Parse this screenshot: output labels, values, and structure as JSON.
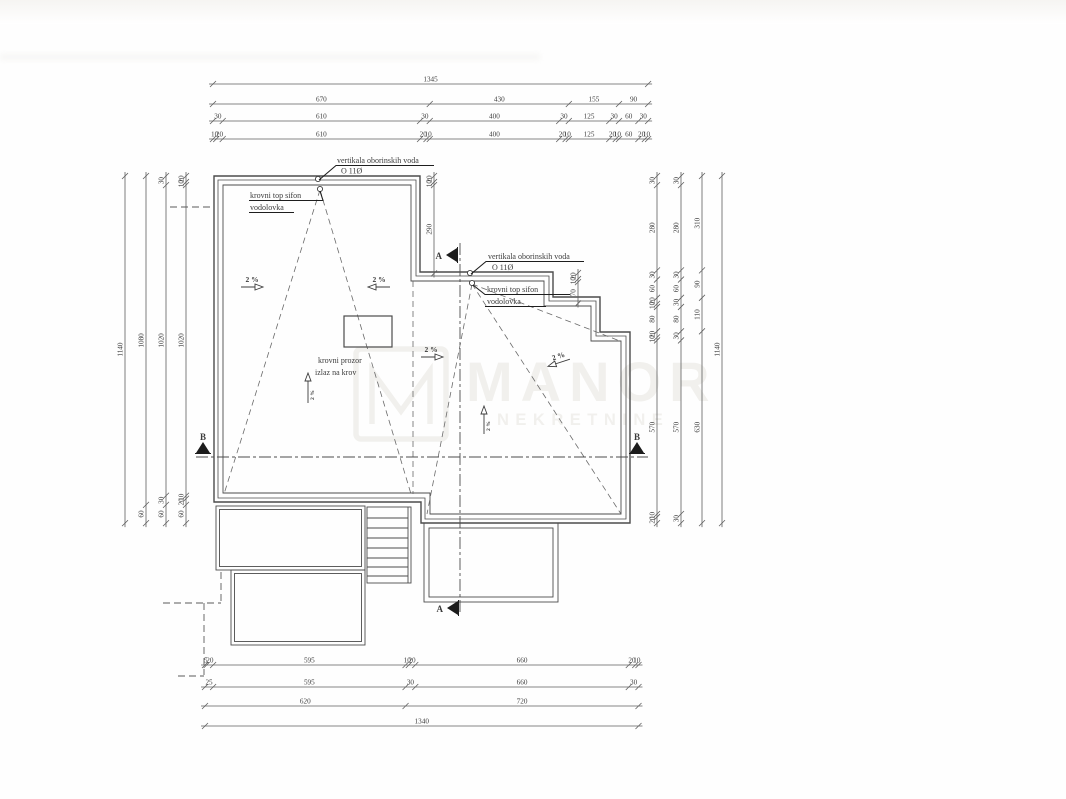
{
  "drawing": {
    "type": "roof plan (architectural drawing)",
    "colors": {
      "line": "#4c4c4c",
      "dim": "#5f5f5f",
      "text": "#3c3c3c",
      "watermark": "#f1f0ed",
      "bg": "#ffffff"
    }
  },
  "watermark": {
    "brand": "MANOR",
    "tagline": "NEKRETNINE"
  },
  "notes": {
    "vertical_drain": "vertikala oborinskih voda",
    "drain_diameter": "O 11Ø",
    "roof_siphon": "krovni top sifon",
    "gutter": "vodolovka",
    "roof_window_line1": "krovni prozor",
    "roof_window_line2": "izlaz na krov",
    "slope": "2 %",
    "section_a": "A",
    "section_b": "B"
  },
  "dim_chains": [
    {
      "name": "top-total",
      "orient": "h",
      "x": 213,
      "y": 84,
      "scale": 0.3235,
      "values": [
        1345
      ]
    },
    {
      "name": "top-groups",
      "orient": "h",
      "x": 213,
      "y": 104,
      "scale": 0.3235,
      "values": [
        670,
        430,
        155,
        90
      ]
    },
    {
      "name": "top-walls",
      "orient": "h",
      "x": 213,
      "y": 121,
      "scale": 0.3235,
      "values": [
        30,
        610,
        30,
        400,
        30,
        125,
        30,
        60,
        30
      ]
    },
    {
      "name": "top-detail",
      "orient": "h",
      "x": 213,
      "y": 139,
      "scale": 0.3235,
      "values": [
        10,
        20,
        610,
        20,
        10,
        400,
        20,
        10,
        125,
        20,
        10,
        60,
        20,
        10
      ]
    },
    {
      "name": "bottom-detail",
      "orient": "h",
      "x": 205,
      "y": 665,
      "scale": 0.3235,
      "values": [
        5,
        20,
        595,
        10,
        20,
        660,
        20,
        10
      ]
    },
    {
      "name": "bottom-walls",
      "orient": "h",
      "x": 205,
      "y": 687,
      "scale": 0.3235,
      "values": [
        25,
        595,
        30,
        660,
        30
      ]
    },
    {
      "name": "bottom-groups",
      "orient": "h",
      "x": 205,
      "y": 706,
      "scale": 0.3235,
      "values": [
        620,
        720
      ]
    },
    {
      "name": "bottom-total",
      "orient": "h",
      "x": 205,
      "y": 726,
      "scale": 0.3235,
      "values": [
        1340
      ]
    },
    {
      "name": "left-total",
      "orient": "v",
      "x": 125,
      "y": 176,
      "scale": 0.3045,
      "values": [
        1140
      ]
    },
    {
      "name": "left-groups",
      "orient": "v",
      "x": 146,
      "y": 176,
      "scale": 0.3045,
      "values": [
        1080,
        60
      ]
    },
    {
      "name": "left-walls",
      "orient": "v",
      "x": 166,
      "y": 176,
      "scale": 0.3045,
      "values": [
        30,
        1020,
        30,
        60
      ]
    },
    {
      "name": "left-detail",
      "orient": "v",
      "x": 186,
      "y": 176,
      "scale": 0.3045,
      "values": [
        20,
        10,
        1020,
        10,
        20,
        60
      ]
    },
    {
      "name": "right-detail",
      "orient": "v",
      "x": 657,
      "y": 176,
      "scale": 0.3045,
      "values": [
        30,
        280,
        30,
        60,
        20,
        10,
        80,
        20,
        10,
        570,
        10,
        20
      ]
    },
    {
      "name": "right-walls",
      "orient": "v",
      "x": 681,
      "y": 176,
      "scale": 0.3045,
      "values": [
        30,
        280,
        30,
        60,
        30,
        80,
        30,
        570,
        30
      ]
    },
    {
      "name": "right-groups",
      "orient": "v",
      "x": 702,
      "y": 176,
      "scale": 0.3045,
      "values": [
        310,
        90,
        110,
        630
      ]
    },
    {
      "name": "right-total",
      "orient": "v",
      "x": 722,
      "y": 176,
      "scale": 0.3045,
      "values": [
        1140
      ]
    },
    {
      "name": "step1-detail",
      "orient": "v",
      "x": 434,
      "y": 176,
      "scale": 0.3045,
      "values": [
        20,
        10,
        290
      ]
    },
    {
      "name": "step2-detail",
      "orient": "v",
      "x": 578,
      "y": 273,
      "scale": 0.3045,
      "values": [
        20,
        10,
        70
      ]
    }
  ]
}
